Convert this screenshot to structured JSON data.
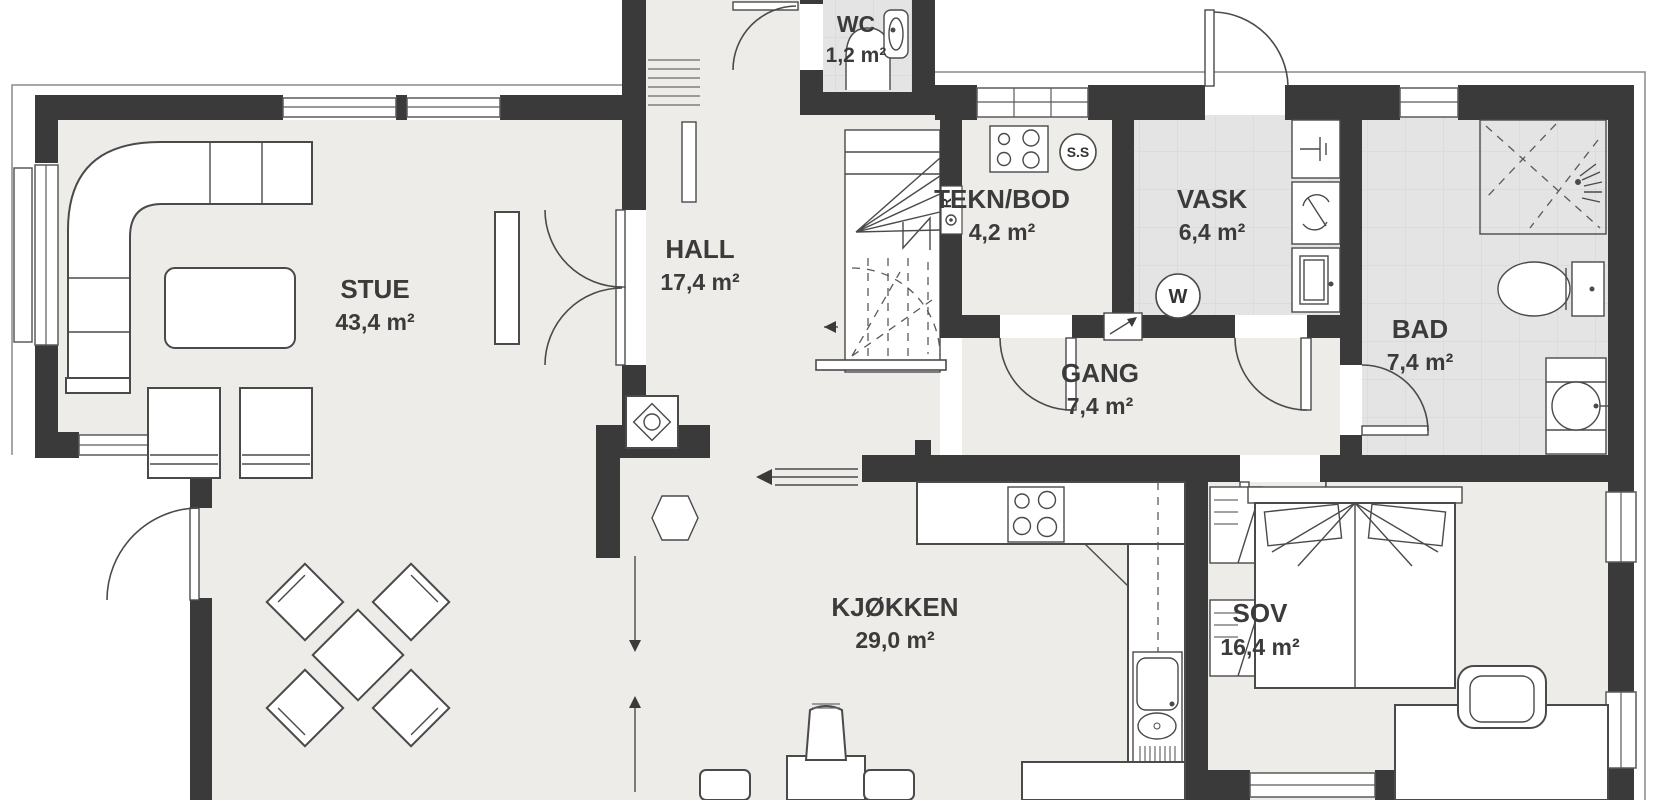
{
  "plan": {
    "title": "floor-plan-first-floor",
    "rooms": [
      {
        "name": "STUE",
        "area": "43,4 m²"
      },
      {
        "name": "HALL",
        "area": "17,4 m²"
      },
      {
        "name": "WC",
        "area": "1,2 m²"
      },
      {
        "name": "TEKN/BOD",
        "area": "4,2 m²"
      },
      {
        "name": "VASK",
        "area": "6,4 m²"
      },
      {
        "name": "GANG",
        "area": "7,4 m²"
      },
      {
        "name": "BAD",
        "area": "7,4 m²"
      },
      {
        "name": "KJØKKEN",
        "area": "29,0 m²"
      },
      {
        "name": "SOV",
        "area": "16,4 m²"
      }
    ],
    "symbols": {
      "central_vacuum": "S.S",
      "washing_machine": "W",
      "riser": "R"
    },
    "colors": {
      "wall": "#3a3a3a",
      "floor": "#edece8",
      "wet_floor": "#e4e4e4",
      "background": "#ffffff",
      "label": "#3b3b3b"
    }
  }
}
